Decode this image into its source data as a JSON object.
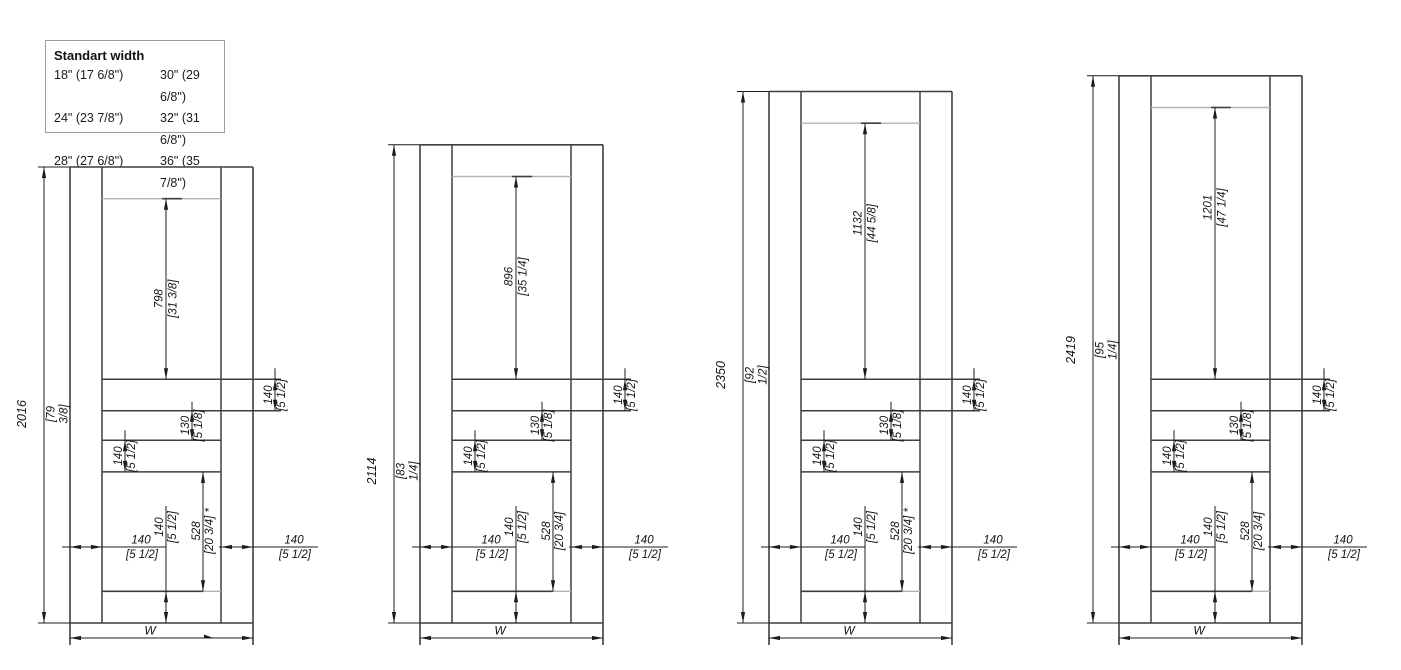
{
  "legend": {
    "title": "Standart width",
    "rows": [
      [
        "18\" (17 6/8\")",
        "30\" (29 6/8\")"
      ],
      [
        "24\" (23 7/8\")",
        "32\" (31 6/8\")"
      ],
      [
        "28\" (27 6/8\")",
        "36\" (35 7/8\")"
      ]
    ]
  },
  "drawing": {
    "width_label": "W",
    "shared_dims": {
      "top_rail_mm": 140,
      "rail1": {
        "mm": 140,
        "label": "140",
        "inch": "[5 1/2]"
      },
      "gap": {
        "mm": 130,
        "label": "130",
        "inch": "[5 1/8]"
      },
      "rail2": {
        "mm": 140,
        "label": "140",
        "inch": "[5 1/2]"
      },
      "opening2": {
        "mm": 528,
        "label": "528",
        "inch": "[20 3/4]",
        "star": "*"
      },
      "bottom_rail": {
        "mm": 140,
        "label": "140",
        "inch": "[5 1/2]"
      },
      "stile": {
        "mm": 140,
        "label": "140",
        "inch": "[5 1/2]"
      }
    },
    "doors": [
      {
        "total_mm": 2016,
        "total_label": "2016",
        "total_inch": "[79 3/8]",
        "top_opening_mm": 798,
        "top_opening_label": "798",
        "top_opening_inch": "[31 3/8]",
        "opening2_star": true
      },
      {
        "total_mm": 2114,
        "total_label": "2114",
        "total_inch": "[83 1/4]",
        "top_opening_mm": 896,
        "top_opening_label": "896",
        "top_opening_inch": "[35 1/4]",
        "opening2_star": false
      },
      {
        "total_mm": 2350,
        "total_label": "2350",
        "total_inch": "[92 1/2]",
        "top_opening_mm": 1132,
        "top_opening_label": "1132",
        "top_opening_inch": "[44 5/8]",
        "opening2_star": true
      },
      {
        "total_mm": 2419,
        "total_label": "2419",
        "total_inch": "[95 1/4]",
        "top_opening_mm": 1201,
        "top_opening_label": "1201",
        "top_opening_inch": "[47 1/4]",
        "opening2_star": false
      }
    ],
    "colors": {
      "line_dark": "#3f3f3f",
      "line_light": "#b3b3b3",
      "line_dim": "#1c1c1c",
      "text": "#141414"
    }
  }
}
